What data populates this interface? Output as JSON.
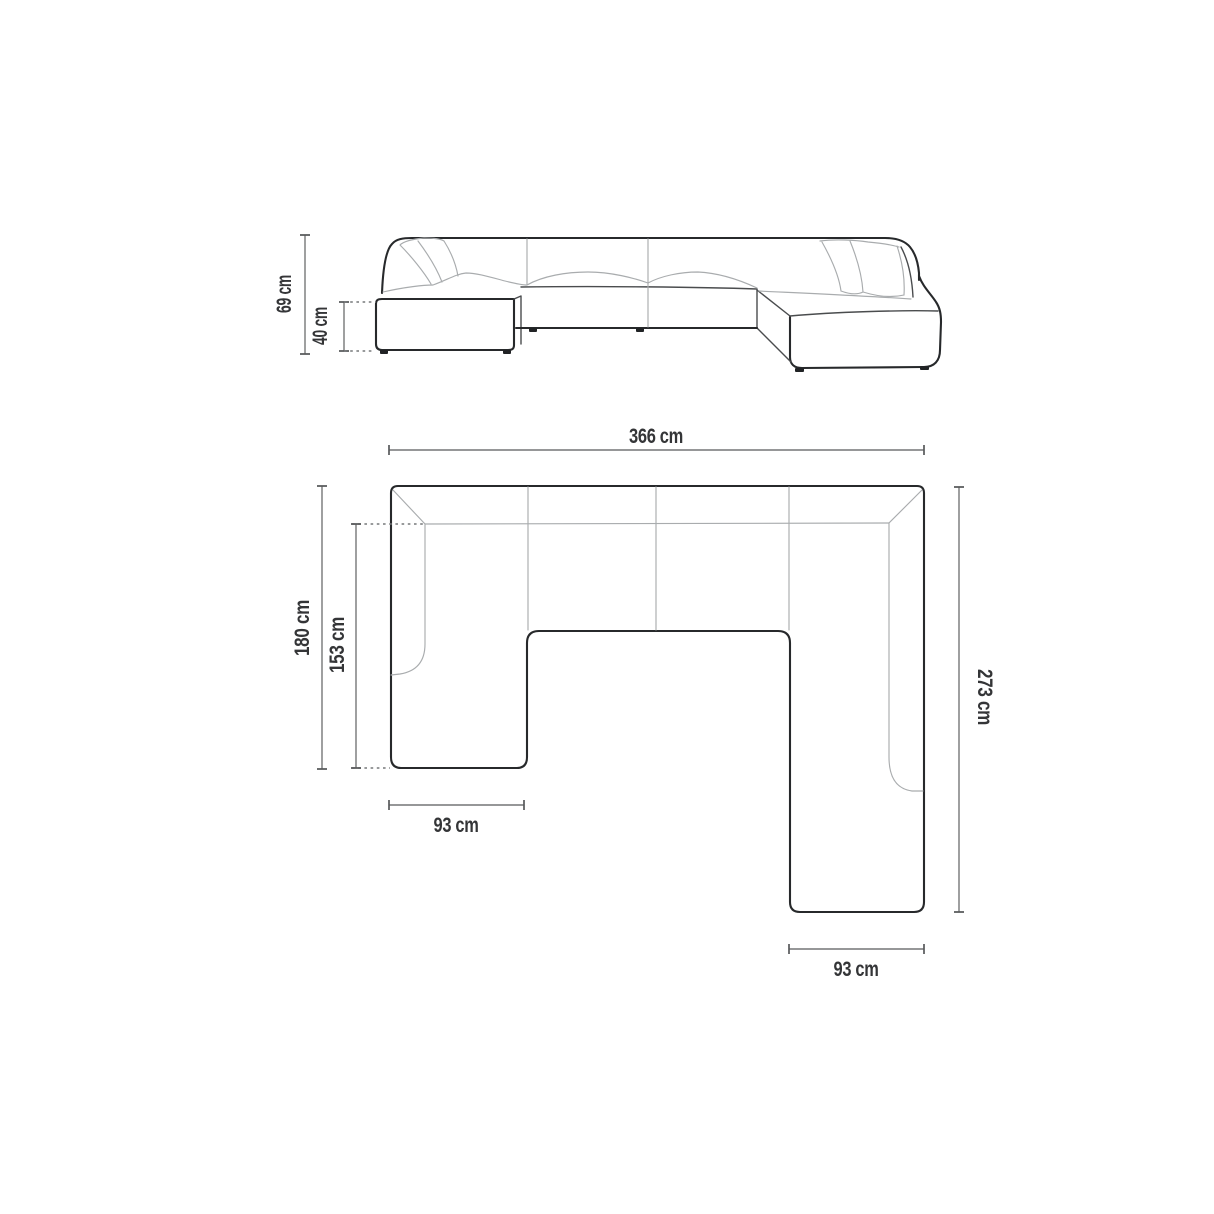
{
  "page": {
    "background": "#ffffff",
    "description": "Technical dimension drawing of a U-shaped panoramic modular sofa: front elevation view above, top plan view below"
  },
  "colors": {
    "outline": "#27292b",
    "detail_line": "#a9acae",
    "dimension_line": "#58595b",
    "label_text": "#343537",
    "background": "#ffffff"
  },
  "views": {
    "front_elevation": {
      "title": "front-elevation",
      "dimensions": {
        "total_height": {
          "label": "69 cm",
          "value": 69,
          "unit": "cm"
        },
        "seat_height": {
          "label": "40 cm",
          "value": 40,
          "unit": "cm"
        }
      }
    },
    "top_plan": {
      "title": "top-plan",
      "dimensions": {
        "total_width": {
          "label": "366 cm",
          "value": 366,
          "unit": "cm"
        },
        "left_side_depth": {
          "label": "180 cm",
          "value": 180,
          "unit": "cm"
        },
        "left_inner_depth": {
          "label": "153 cm",
          "value": 153,
          "unit": "cm"
        },
        "right_side_depth": {
          "label": "273 cm",
          "value": 273,
          "unit": "cm"
        },
        "left_chaise_width": {
          "label": "93 cm",
          "value": 93,
          "unit": "cm"
        },
        "right_chaise_width": {
          "label": "93 cm",
          "value": 93,
          "unit": "cm"
        }
      }
    }
  }
}
